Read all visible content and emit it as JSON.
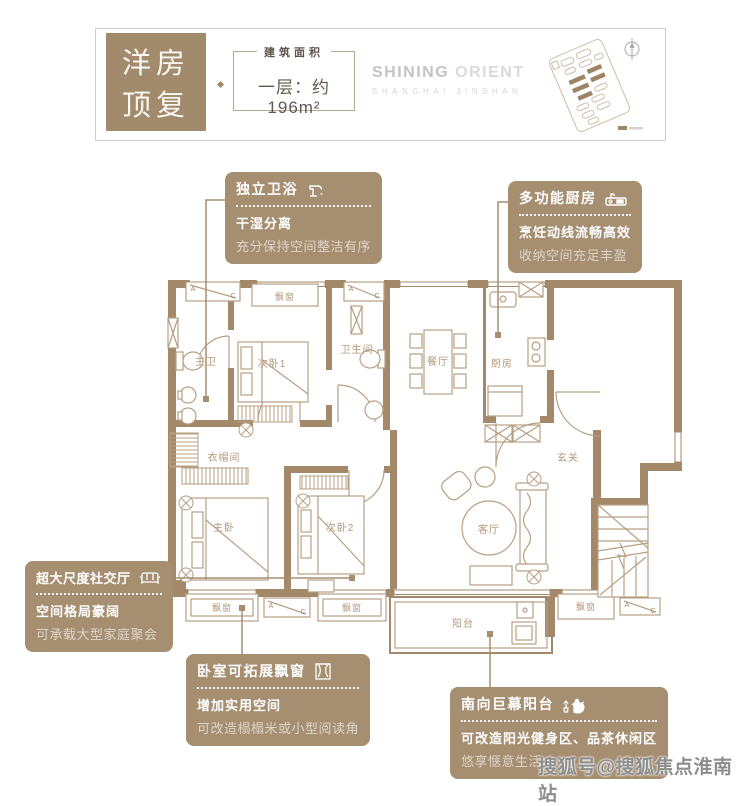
{
  "header": {
    "type_line1": "洋房",
    "type_line2": "顶复",
    "area_caption": "建筑面积",
    "area_value": "一层：约196m²",
    "brand_strong": "SHINING",
    "brand_light": "ORIENT",
    "brand_sub": "SHANGHAI JINSHAN"
  },
  "callouts": [
    {
      "title": "独立卫浴",
      "icon": "faucet-icon",
      "line1": "干湿分离",
      "line2": "充分保持空间整洁有序"
    },
    {
      "title": "多功能厨房",
      "icon": "kitchen-sink-icon",
      "line1": "烹饪动线流畅高效",
      "line2": "收纳空间充足丰盈"
    },
    {
      "title": "超大尺度社交厅",
      "icon": "sofa-icon",
      "line1": "空间格局豪阔",
      "line2": "可承载大型家庭聚会"
    },
    {
      "title": "卧室可拓展飘窗",
      "icon": "bay-window-icon",
      "line1": "增加实用空间",
      "line2": "可改造榻榻米或小型阅读角"
    },
    {
      "title": "南向巨幕阳台",
      "icon": "tea-set-icon",
      "line1": "可改造阳光健身区、品茶休闲区",
      "line2": "悠享惬意生活"
    }
  ],
  "plan": {
    "rooms": {
      "master_bath": "主卫",
      "bedroom1": "次卧1",
      "bathroom": "卫生间",
      "dining": "餐厅",
      "kitchen": "厨房",
      "cloakroom": "衣帽间",
      "master_bedroom": "主卧",
      "bedroom2": "次卧2",
      "foyer": "玄关",
      "living": "客厅",
      "balcony": "阳台",
      "bay_window": "飘窗"
    },
    "marker_a": "A",
    "marker_c": "C"
  },
  "watermark": "搜狐号@搜狐焦点淮南站",
  "colors": {
    "wall": "#a3886a",
    "callout_bg": "#a68e70",
    "badge_bg": "#a28a6c",
    "room_label": "#b3997a",
    "brand_gray": "#c6c6c6",
    "watermark_gray": "#8d8d8d"
  }
}
